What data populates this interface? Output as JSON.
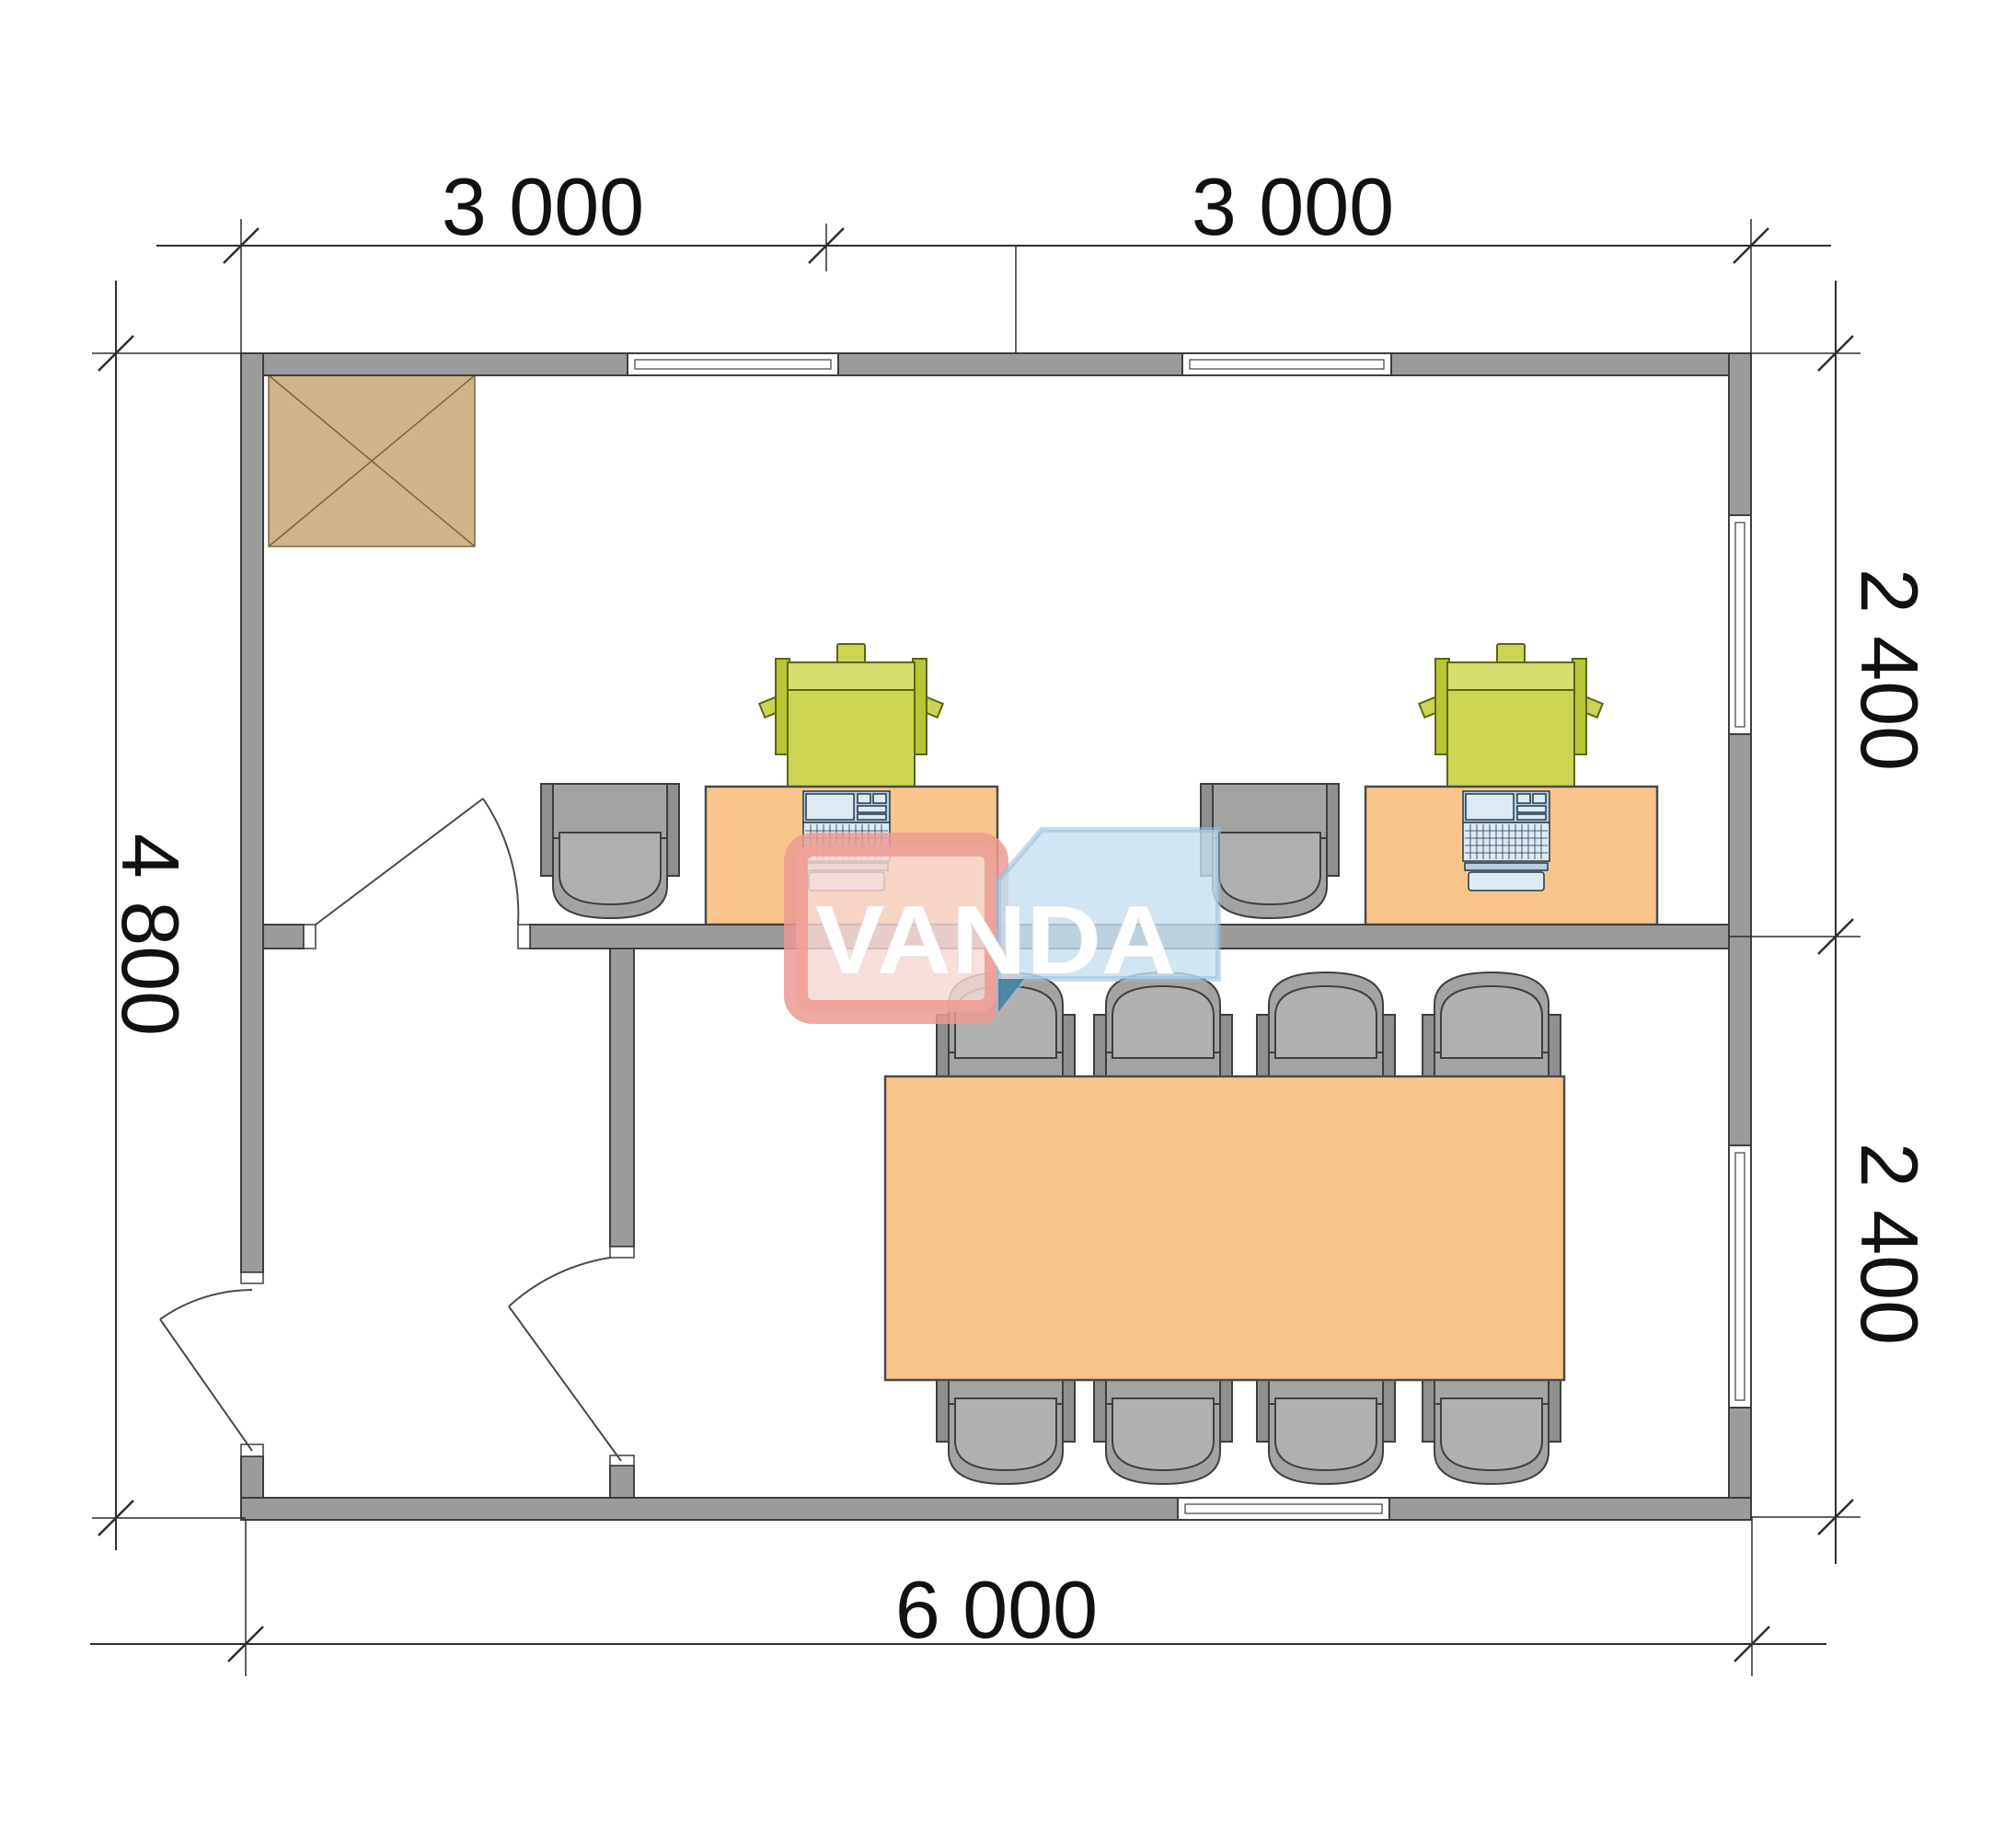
{
  "watermark": {
    "text": "VANDA"
  },
  "dimensions": {
    "top_left": "3 000",
    "top_right": "3 000",
    "left": "4 800",
    "right_upper": "2 400",
    "right_lower": "2 400",
    "bottom": "6 000"
  },
  "plan_objects": [
    "exterior-walls",
    "interior-partition-horizontal",
    "interior-partition-vertical",
    "entrance-door",
    "office-door",
    "meeting-room-door",
    "window-top-left",
    "window-top-right",
    "window-right-upper",
    "window-right-lower",
    "window-bottom",
    "ventilation-shaft-hatch",
    "workstation-desk-1",
    "workstation-desk-2",
    "office-chair-1",
    "office-chair-2",
    "laptop-1",
    "laptop-2",
    "printer-1",
    "printer-2",
    "meeting-table",
    "meeting-chairs-top-row",
    "meeting-chairs-bottom-row"
  ],
  "colors": {
    "wall": "#9b9b9b",
    "wall_line": "#3e3e3e",
    "window_fill": "#ffffff",
    "door_line": "#4a4a4a",
    "desk": "#f9c58b",
    "furniture_line": "#4a4a4a",
    "chair": "#a3a3a3",
    "chair_light": "#b0b0b0",
    "chair_dark": "#8f8f8f",
    "printer": "#ccd553",
    "printer_light": "#d6de70",
    "printer_dark": "#b8c535",
    "printer_line": "#5c660f",
    "laptop": "#b9cfe2",
    "laptop_light": "#dde9f3",
    "laptop_line": "#23384d",
    "hatch": "#cfb489",
    "hatch_line": "#77663f",
    "dim": "#2e2e2e",
    "text": "#111111",
    "wm_red_fill": "rgba(247,216,211,0.82)",
    "wm_red_edge": "rgba(236,154,146,0.85)",
    "wm_blue": "rgba(197,222,240,0.80)",
    "wm_blue_edge": "rgba(150,190,220,0.55)",
    "wm_teal": "rgba(52,116,146,0.80)",
    "wm_text": "#ffffff"
  }
}
